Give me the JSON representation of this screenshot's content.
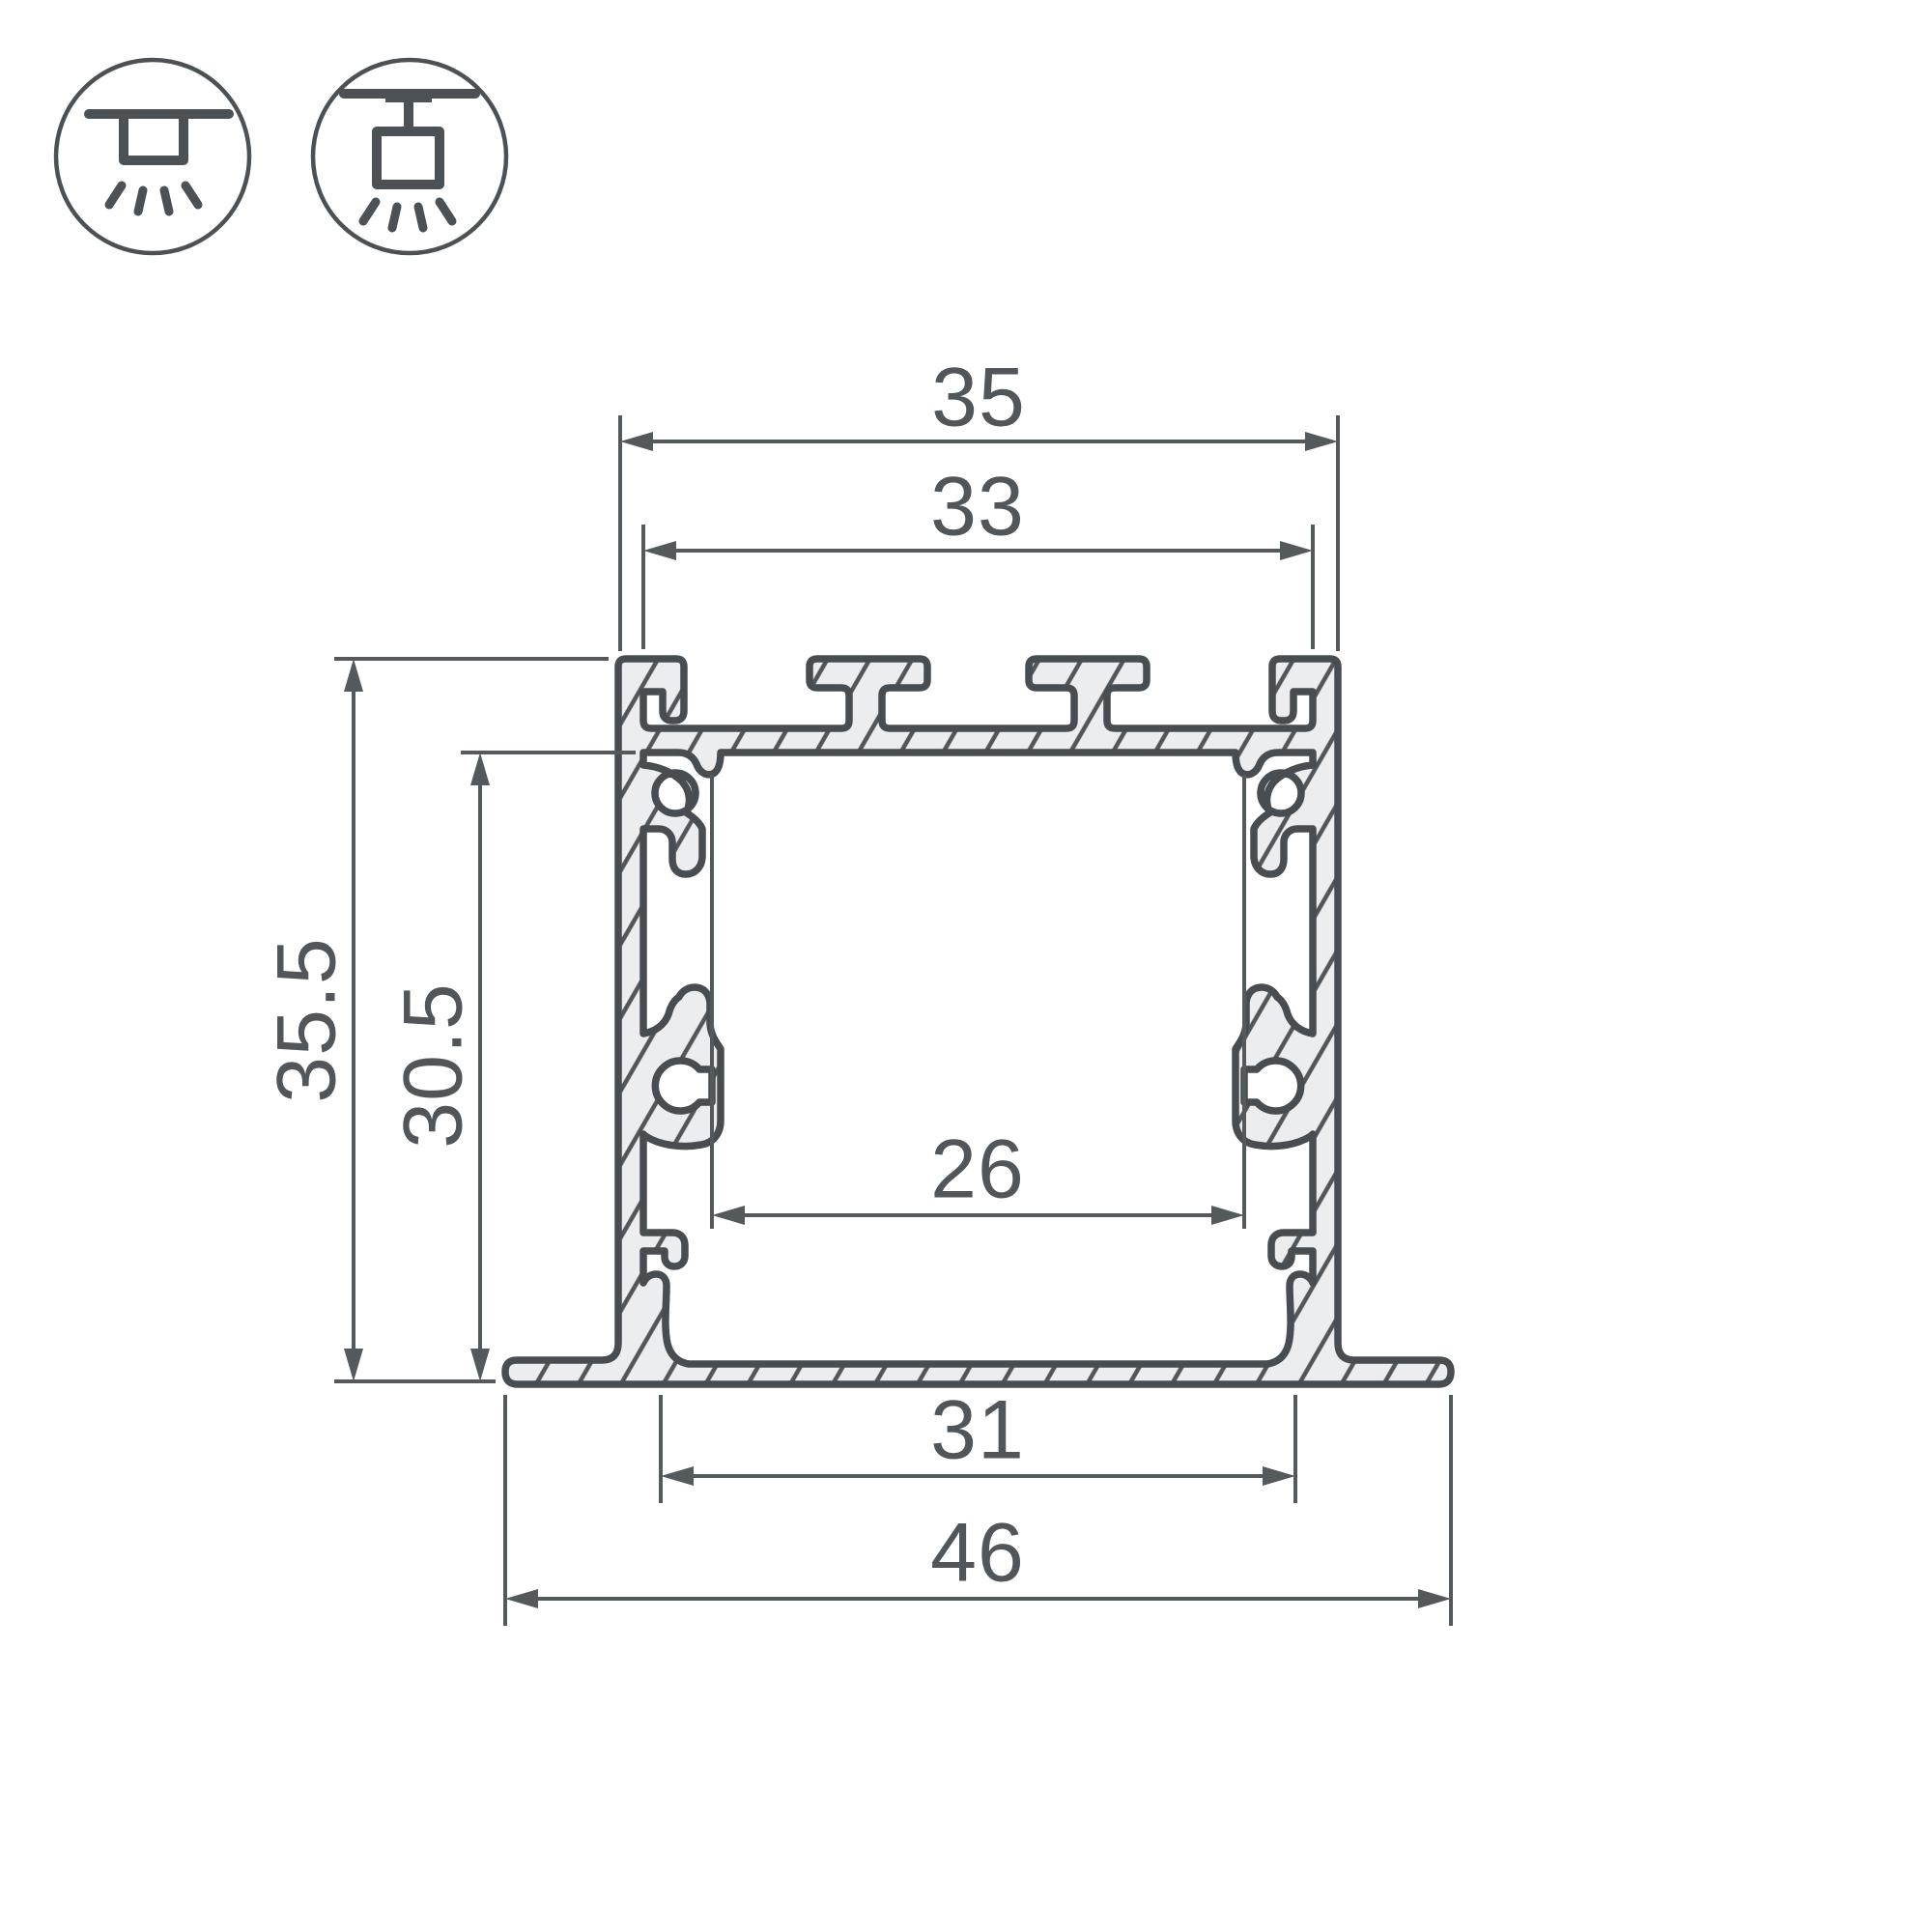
{
  "diagram": {
    "type": "technical-cross-section",
    "subject": "recessed LED profile",
    "units": "mm"
  },
  "icons": [
    {
      "name": "recessed-mount-icon",
      "meaning": "flush recessed ceiling mounting with downlight rays"
    },
    {
      "name": "surface-mount-icon",
      "meaning": "surface/track ceiling mounting with downlight rays"
    }
  ],
  "dimensions": {
    "top_outer_width": "35",
    "top_inner_width": "33",
    "outer_height": "35.5",
    "inner_height": "30.5",
    "inner_cavity_width": "26",
    "bottom_opening_width": "31",
    "total_flange_width": "46"
  },
  "colors": {
    "outline": "#474d50",
    "metal_fill": "#ecedee",
    "hatch": "#50565a",
    "dimension_lines": "#54595c",
    "text": "#50565a",
    "background": "#ffffff"
  }
}
